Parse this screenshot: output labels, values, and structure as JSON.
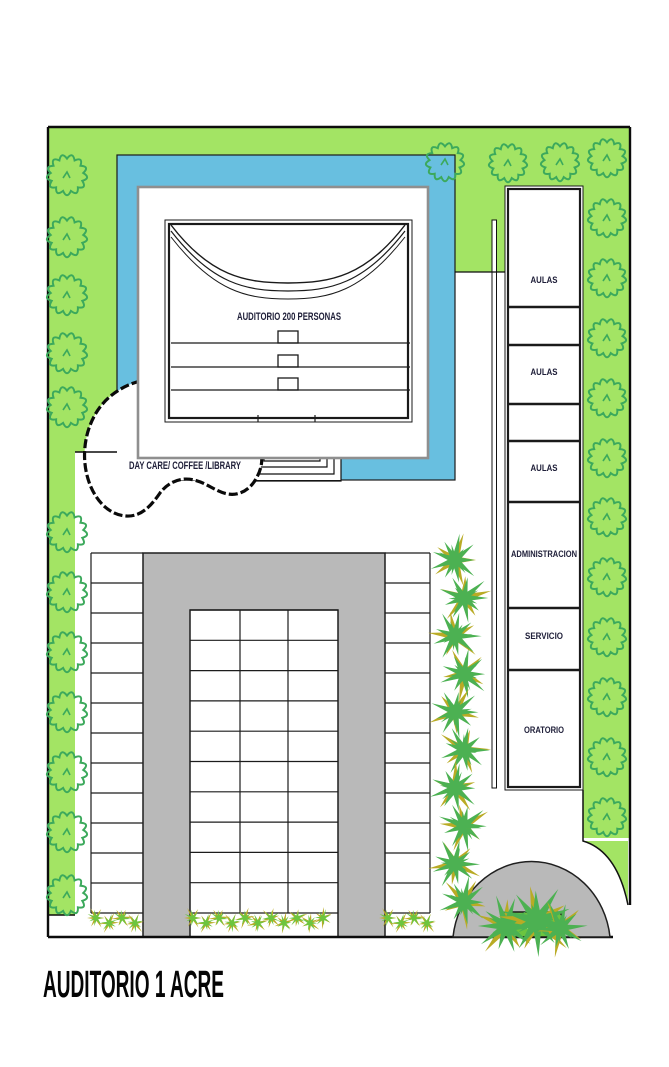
{
  "title": "AUDITORIO 1 ACRE",
  "auditorium": {
    "label": "AUDITORIO 200 PERSONAS"
  },
  "daycare": {
    "label": "DAY CARE/ COFFEE /LIBRARY"
  },
  "rooms": {
    "labels": [
      "AULAS",
      "AULAS",
      "AULAS",
      "ADMINISTRACION",
      "SERVICIO",
      "ORATORIO"
    ]
  },
  "colors": {
    "grass": "#a3e464",
    "foliage": "#3ca95c",
    "pool": "#68bfe0",
    "pavement": "#b9b9b9",
    "palm": "#4cb152",
    "hedge": "#6cc53f",
    "olive": "#b9ab25",
    "ink": "#20203a"
  }
}
